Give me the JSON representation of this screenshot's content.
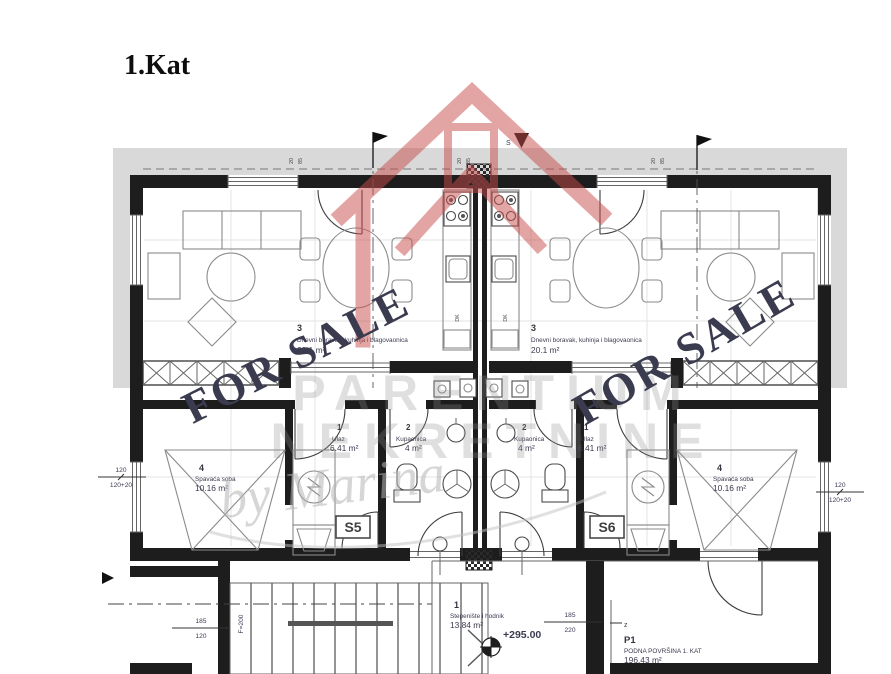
{
  "title": "1.Kat",
  "watermark": {
    "brand_line1": "PARENTIUM",
    "brand_line2": "NEKRETNINE",
    "signature": "by Marina",
    "for_sale": "FOR SALE"
  },
  "units": {
    "left": {
      "id": "S5",
      "living_num": "3",
      "living_name": "Dnevni boravak, kuhinja i blagovaonica",
      "living_area": "20.1 m²",
      "entry_num": "1",
      "entry_name": "Ulaz",
      "entry_area": "6.41 m²",
      "bath_num": "2",
      "bath_name": "Kupaonica",
      "bath_area": "4 m²",
      "bedroom_num": "4",
      "bedroom_name": "Spavaća soba",
      "bedroom_area": "10.16 m²",
      "kitchen_code": "DK"
    },
    "right": {
      "id": "S6",
      "living_num": "3",
      "living_name": "Dnevni boravak, kuhinja i blagovaonica",
      "living_area": "20.1 m²",
      "entry_num": "1",
      "entry_name": "Ulaz",
      "entry_area": "6.41 m²",
      "bath_num": "2",
      "bath_name": "Kupaonica",
      "bath_area": "4 m²",
      "bedroom_num": "4",
      "bedroom_name": "Spavaća soba",
      "bedroom_area": "10.16 m²",
      "kitchen_code": "DK"
    }
  },
  "common_areas": {
    "hallway_num": "1",
    "hallway_name": "Stepenište i hodnik",
    "hallway_area": "13.84 m²",
    "level": "+295.00",
    "summary_code": "P1",
    "summary_label": "PODNA POVRŠINA 1. KAT",
    "summary_area": "196.43 m²"
  },
  "dimensions": {
    "left_top": "120",
    "left_bottom": "120+20",
    "right_top": "120",
    "right_bottom": "120+20",
    "stair_top": "185",
    "stair_bottom": "120",
    "hall_top": "185",
    "hall_bottom": "220",
    "stair_side": "F=200",
    "door_o": "20",
    "door_w": "85"
  },
  "markers": {
    "section": "S",
    "axis": "z"
  },
  "colors": {
    "for_sale": "#2b3470",
    "logo": "#c94b4b"
  }
}
